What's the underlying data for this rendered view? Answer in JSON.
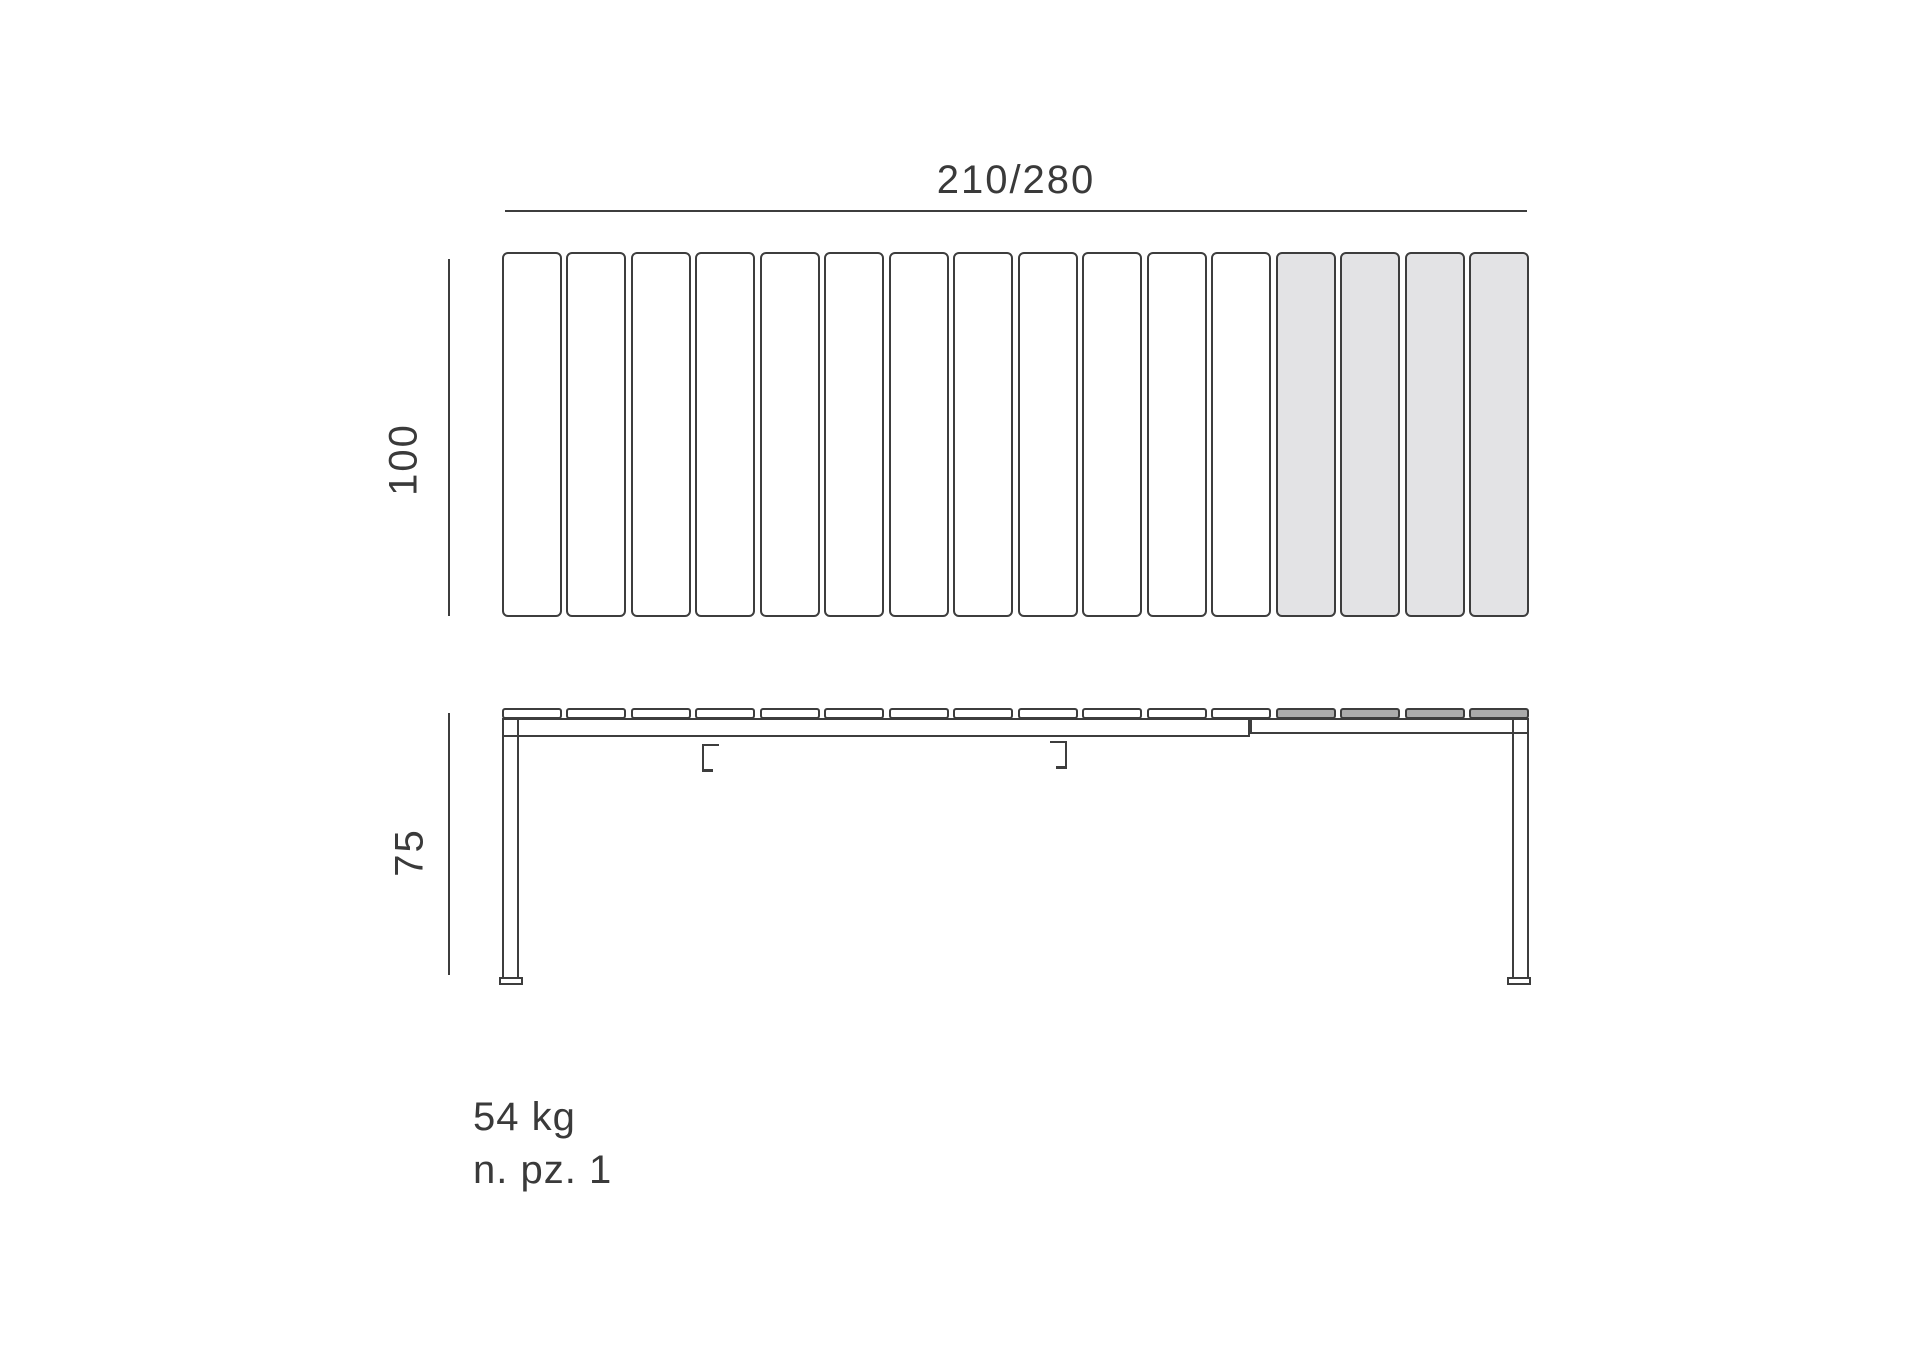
{
  "diagram": {
    "colors": {
      "background": "#ffffff",
      "stroke": "#3d3d3d",
      "text": "#3a3a3a",
      "top_view_white_fill": "#ffffff",
      "top_view_gray_fill": "#e3e3e5",
      "side_view_white_fill": "#ffffff",
      "side_view_gray_fill": "#ababab"
    },
    "top_view": {
      "width_label": "210/280",
      "depth_label": "100",
      "slat_count_total": 16,
      "white_slat_count": 12,
      "gray_slat_count": 4
    },
    "side_view": {
      "height_label": "75",
      "cap_count_total": 16,
      "white_cap_count": 12,
      "gray_cap_count": 4
    },
    "footer": {
      "weight": "54 kg",
      "pieces": "n. pz. 1"
    }
  }
}
